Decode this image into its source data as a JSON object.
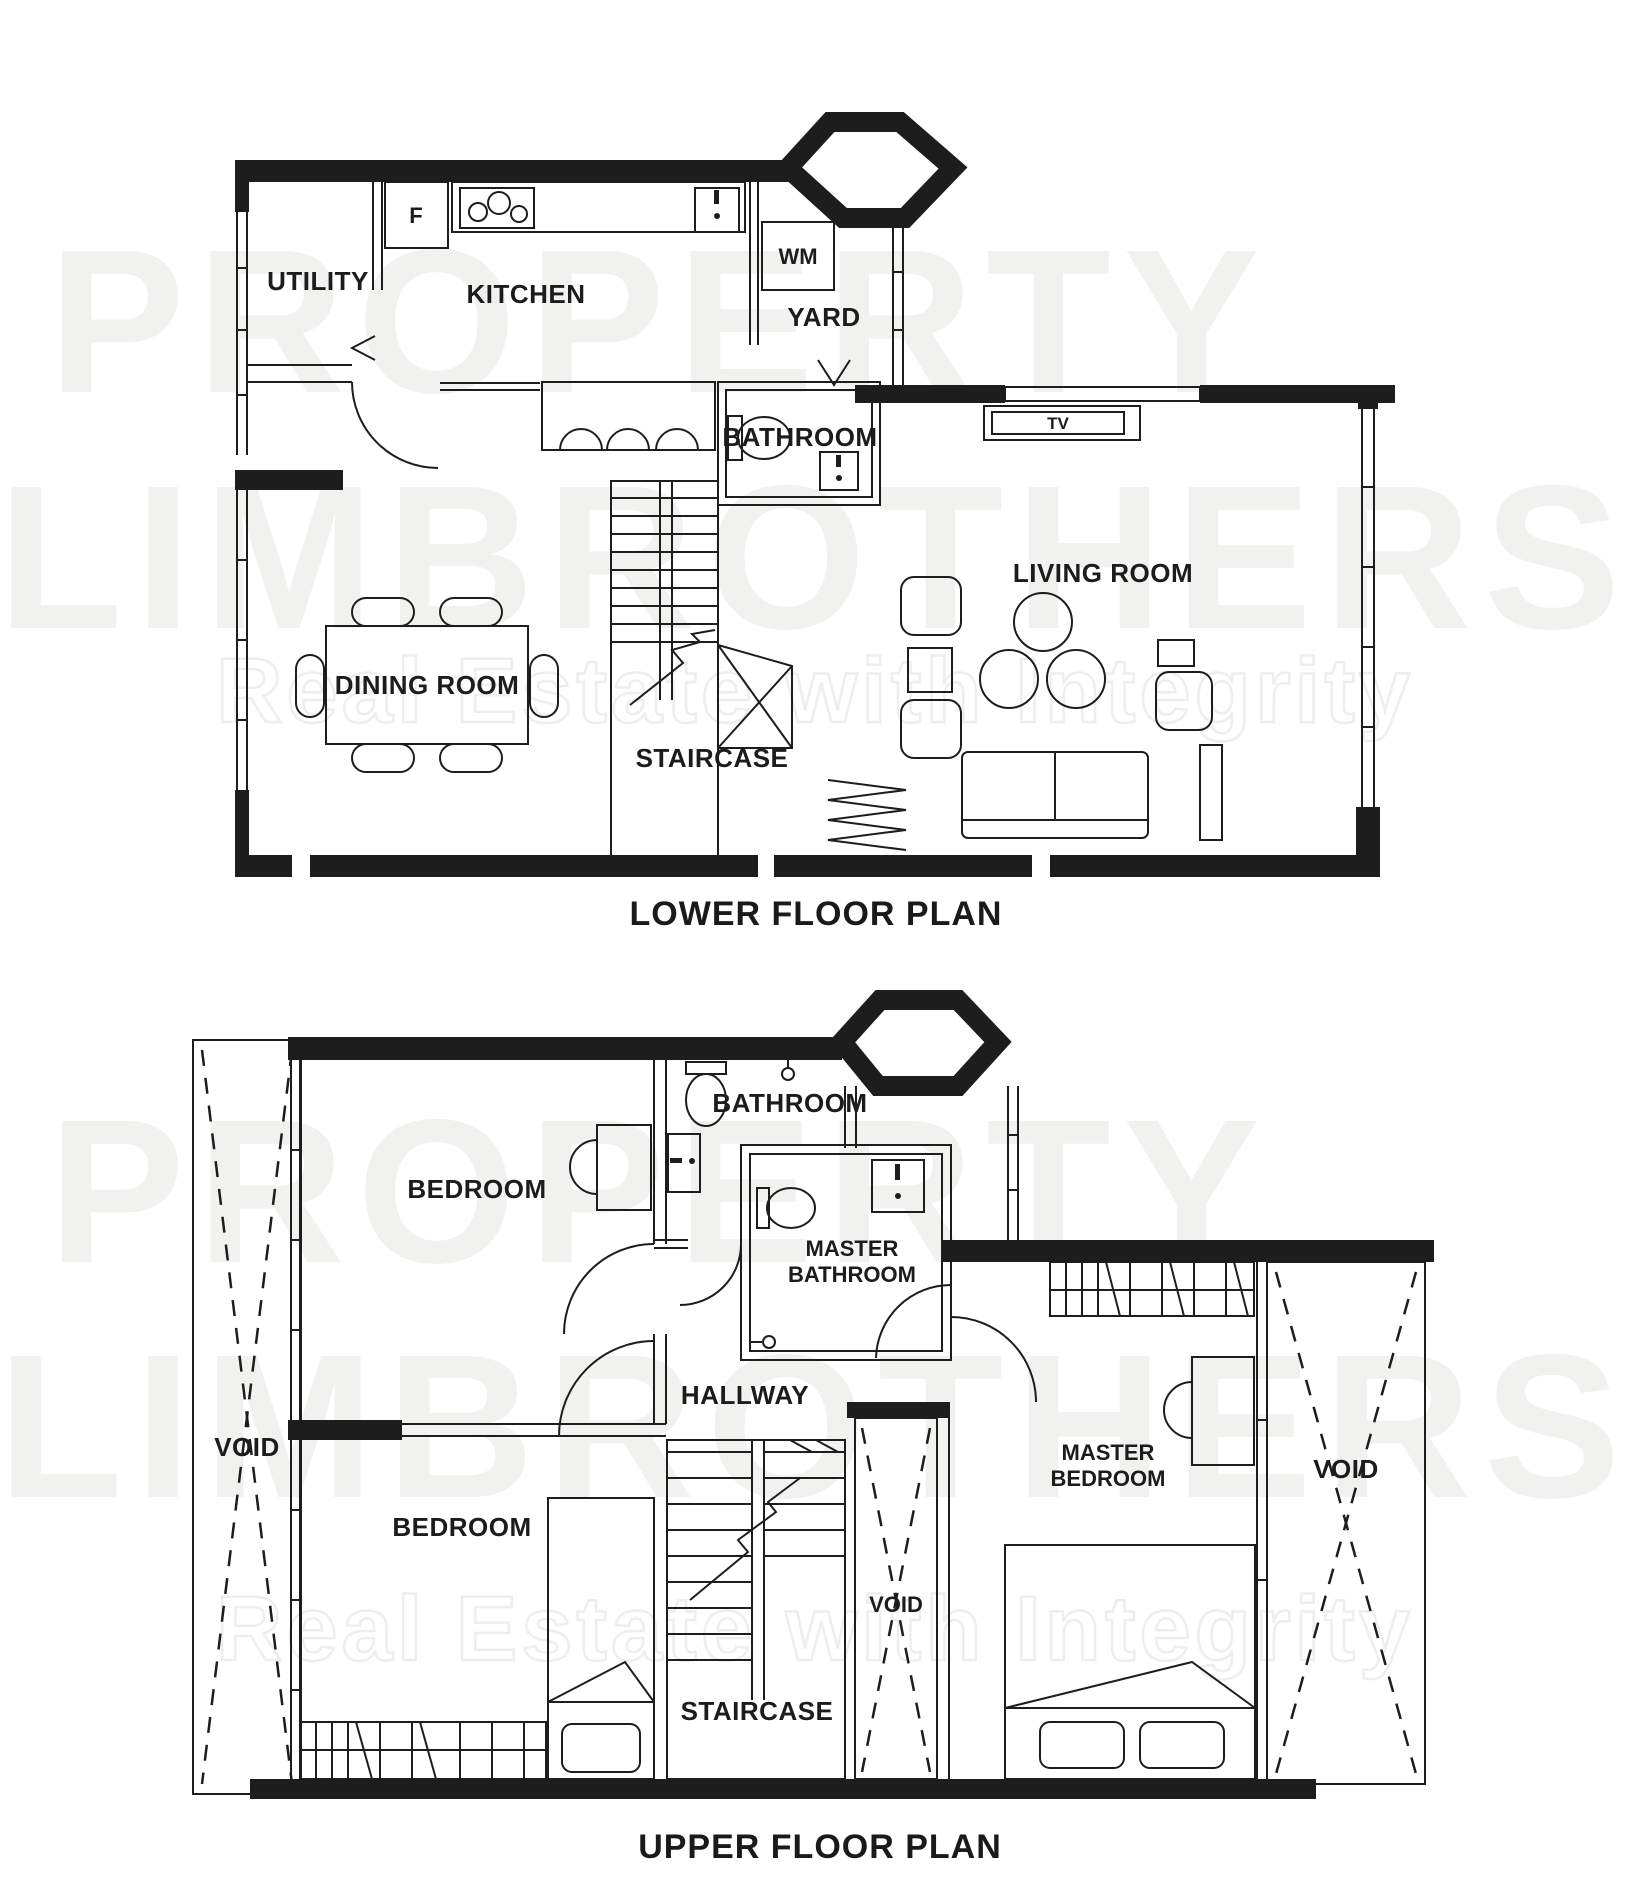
{
  "watermark": {
    "brand_line1": "PROPERTY",
    "brand_line2": "LIMBROTHERS",
    "tagline": "Real Estate with Integrity"
  },
  "lower_floor": {
    "title": "LOWER FLOOR PLAN",
    "rooms": {
      "utility": "UTILITY",
      "kitchen": "KITCHEN",
      "yard": "YARD",
      "bathroom": "BATHROOM",
      "living_room": "LIVING ROOM",
      "dining_room": "DINING ROOM",
      "staircase": "STAIRCASE"
    },
    "appliances": {
      "fridge": "F",
      "washing_machine": "WM",
      "tv": "TV"
    }
  },
  "upper_floor": {
    "title": "UPPER FLOOR PLAN",
    "rooms": {
      "bathroom": "BATHROOM",
      "bedroom_top": "BEDROOM",
      "master_bathroom_line1": "MASTER",
      "master_bathroom_line2": "BATHROOM",
      "hallway": "HALLWAY",
      "bedroom_bottom": "BEDROOM",
      "master_bedroom_line1": "MASTER",
      "master_bedroom_line2": "BEDROOM",
      "staircase": "STAIRCASE",
      "void_left": "VOID",
      "void_middle": "VOID",
      "void_right": "VOID"
    }
  },
  "colors": {
    "background": "#ffffff",
    "line": "#1d1d1d",
    "watermark_fill": "#f1f1f0"
  }
}
